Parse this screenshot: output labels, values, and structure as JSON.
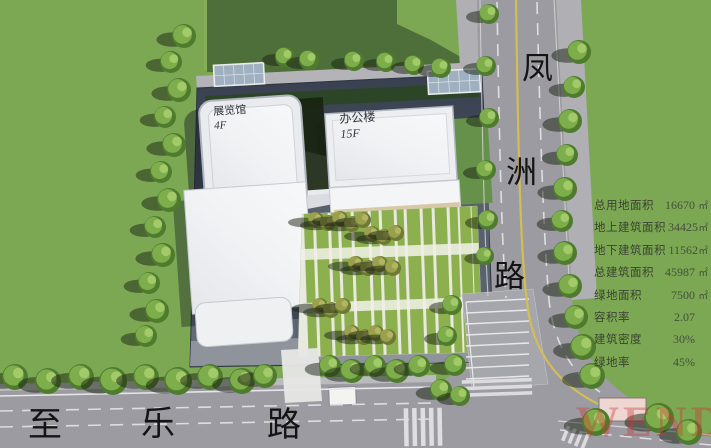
{
  "title": "建筑总平面图 (site plan rendering)",
  "roads": {
    "fengzhou": {
      "name": "凤洲路",
      "chars": [
        "凤",
        "洲",
        "路"
      ]
    },
    "zhile": {
      "name": "至乐路",
      "chars": [
        "至",
        "乐",
        "路"
      ]
    }
  },
  "buildings": {
    "exhibition": {
      "name": "展览馆",
      "floors": "4F"
    },
    "office": {
      "name": "办公楼",
      "floors": "15F"
    }
  },
  "stats": {
    "rows": [
      {
        "label": "总用地面积",
        "value": "16670",
        "unit": "㎡"
      },
      {
        "label": "地上建筑面积",
        "value": "34425",
        "unit": "㎡"
      },
      {
        "label": "地下建筑面积",
        "value": "11562",
        "unit": "㎡"
      },
      {
        "label": "总建筑面积",
        "value": "45987",
        "unit": "㎡"
      },
      {
        "label": "绿地面积",
        "value": "7500",
        "unit": "㎡"
      },
      {
        "label": "容积率",
        "value": "2.07",
        "unit": ""
      },
      {
        "label": "建筑密度",
        "value": "30%",
        "unit": ""
      },
      {
        "label": "绿地率",
        "value": "45%",
        "unit": ""
      }
    ]
  },
  "watermark": "WEND",
  "colors": {
    "grass": "#7CA854",
    "shadow_green": "#4E6F3A",
    "road": "#9B9BA1",
    "sidewalk": "#B4B4B8",
    "site_dark": "#394050",
    "site_light": "#6B717D",
    "building": "#F2F3F5",
    "stripe_green": "#8DB04F",
    "stripe_pale": "#E9EADF",
    "beige": "#D7C8A6",
    "tree": "#7EAD4B",
    "olive_tree": "#9AA04B",
    "center_line_yellow": "#D3BE54",
    "watermark_red": "#CA3730"
  }
}
